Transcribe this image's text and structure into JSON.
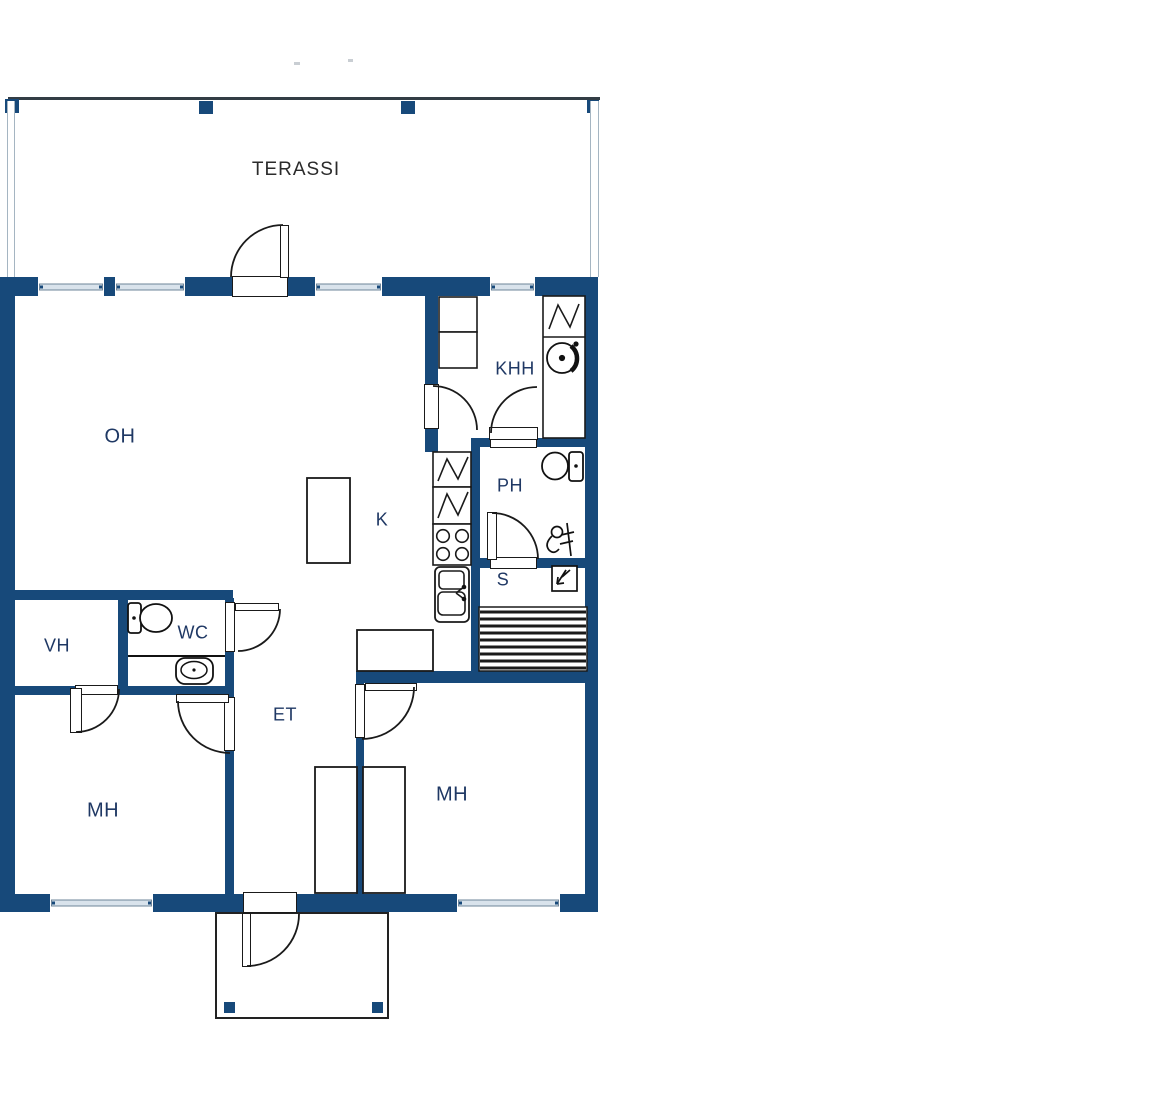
{
  "title": "Apartment floor plan",
  "colors": {
    "wall": "#17497A",
    "room_label": "#1F3864",
    "terrace_label": "#2B2B2B",
    "window_sill": "#D9E3EC",
    "window_sill_border": "#6D8499",
    "line": "#1A1A1A"
  },
  "rooms": {
    "terassi": "TERASSI",
    "oh": "OH",
    "khh": "KHH",
    "ph": "PH",
    "k": "K",
    "s": "S",
    "vh": "VH",
    "wc": "WC",
    "et": "ET",
    "mh_left": "MH",
    "mh_right": "MH"
  },
  "fixtures": [
    "terrace-posts",
    "terrace-railing",
    "terrace-door",
    "entrance-door",
    "entrance-porch",
    "windows",
    "wc-toilet",
    "wc-sink",
    "ph-toilet",
    "ph-shower",
    "sauna-heater",
    "sauna-benches",
    "kitchen-cooktop",
    "kitchen-sink",
    "kitchen-island",
    "kitchen-counter",
    "cold-appliance",
    "drying-cabinet",
    "washing-machine",
    "khh-cabinets",
    "wardrobes"
  ]
}
